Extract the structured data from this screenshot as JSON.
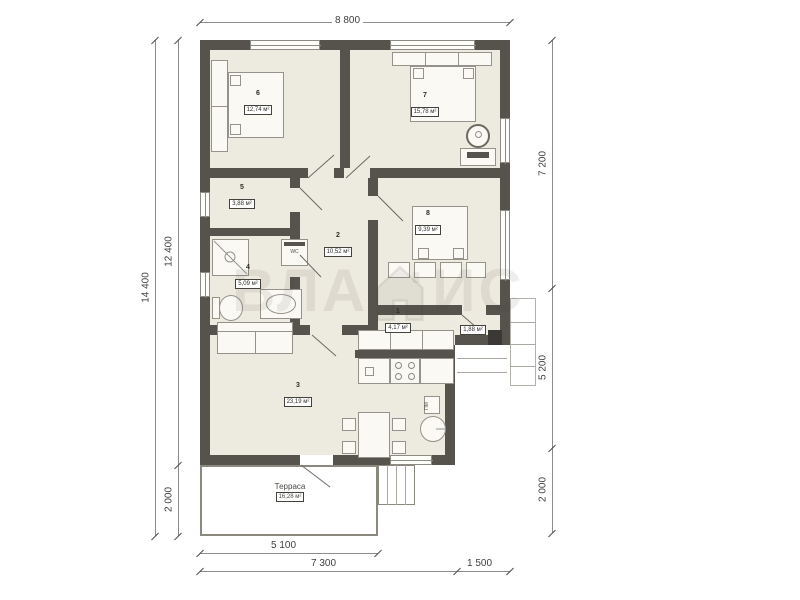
{
  "watermark": {
    "left": "ВЛА",
    "right": "ИС"
  },
  "dimensions": {
    "top": "8 800",
    "left_outer": "14 400",
    "left_upper": "12 400",
    "left_lower": "2 000",
    "right_upper": "7 200",
    "right_middle": "5 200",
    "right_lower": "2 000",
    "bottom_terrace": "5 100",
    "bottom_main": "7 300",
    "bottom_side": "1 500"
  },
  "rooms": [
    {
      "number": "1",
      "area": "4,17 м²"
    },
    {
      "number": "2",
      "area": "10,52 м²"
    },
    {
      "number": "3",
      "area": "23,19 м²"
    },
    {
      "number": "4",
      "area": "5,09 м²"
    },
    {
      "number": "5",
      "area": "3,88 м²"
    },
    {
      "number": "6",
      "area": "12,74 м²"
    },
    {
      "number": "7",
      "area": "15,78 м²"
    },
    {
      "number": "8",
      "area": "9,39 м²"
    }
  ],
  "terrace": {
    "name": "Терраса",
    "area": "16,28 м²"
  },
  "annex": {
    "area": "1,88 м²"
  },
  "appliances": {
    "washing_machine": "WC",
    "dishwasher": "ПМ"
  }
}
